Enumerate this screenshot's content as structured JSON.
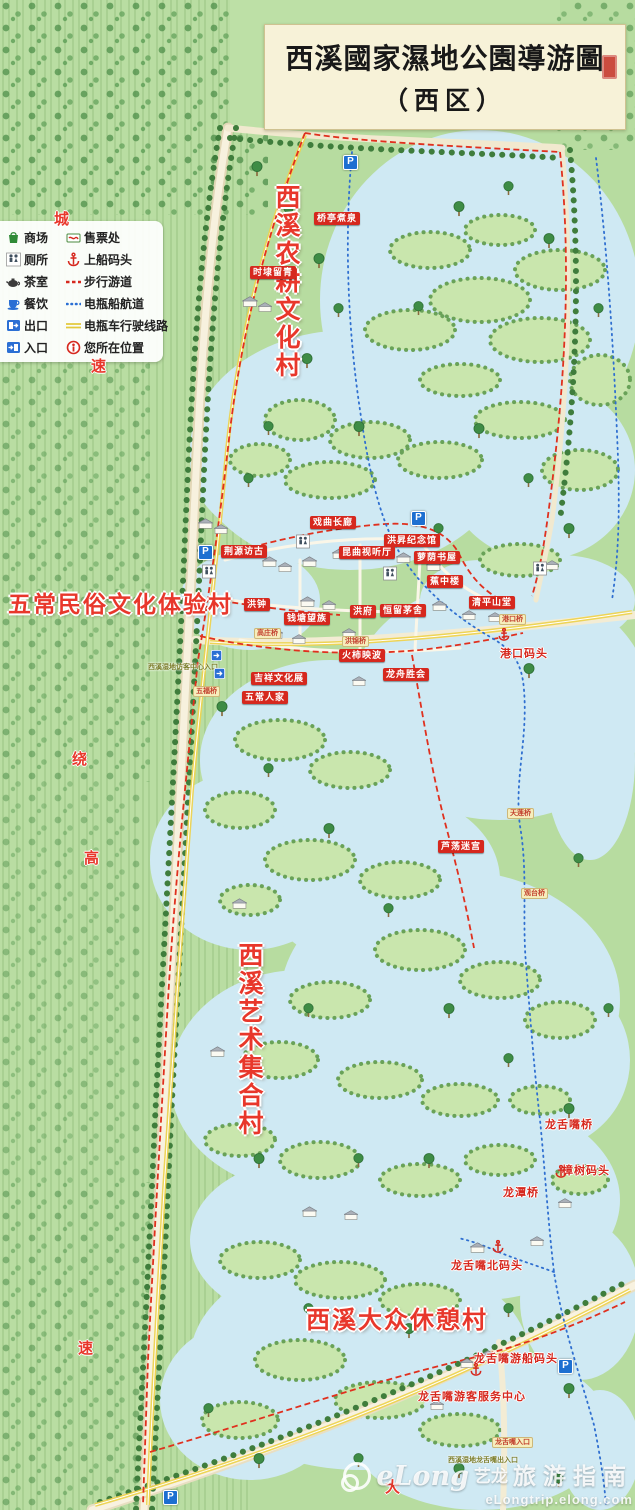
{
  "title": {
    "main": "西溪國家濕地公園導游圖",
    "sub": "（西区）"
  },
  "legend": {
    "items": [
      {
        "icon": "shop-icon",
        "label": "商场"
      },
      {
        "icon": "ticket-office-icon",
        "label": "售票处"
      },
      {
        "icon": "toilet-icon",
        "label": "厕所"
      },
      {
        "icon": "boat-dock-icon",
        "label": "上船码头"
      },
      {
        "icon": "tea-room-icon",
        "label": "茶室"
      },
      {
        "icon": "walking-route-icon",
        "label": "步行游道"
      },
      {
        "icon": "dining-icon",
        "label": "餐饮"
      },
      {
        "icon": "boat-route-icon",
        "label": "电瓶船航道"
      },
      {
        "icon": "exit-icon",
        "label": "出口"
      },
      {
        "icon": "cart-route-icon",
        "label": "电瓶车行驶线路"
      },
      {
        "icon": "entrance-icon",
        "label": "入口"
      },
      {
        "icon": "current-location-icon",
        "label": "您所在位置"
      }
    ]
  },
  "villages": [
    {
      "name": "西溪农耕文化村"
    },
    {
      "name": "五常民俗文化体验村"
    },
    {
      "name": "西溪艺术集合村"
    },
    {
      "name": "西溪大众休憩村"
    }
  ],
  "pois": [
    {
      "label": "桥亭煮泉",
      "x": 314,
      "y": 212
    },
    {
      "label": "时埭留青",
      "x": 250,
      "y": 266
    },
    {
      "label": "荆源访古",
      "x": 221,
      "y": 545
    },
    {
      "label": "戏曲长廊",
      "x": 310,
      "y": 516
    },
    {
      "label": "洪昇纪念馆",
      "x": 384,
      "y": 534
    },
    {
      "label": "昆曲视听厅",
      "x": 339,
      "y": 546
    },
    {
      "label": "萝荫书屋",
      "x": 414,
      "y": 551
    },
    {
      "label": "洪钟",
      "x": 244,
      "y": 598
    },
    {
      "label": "蕉中楼",
      "x": 427,
      "y": 575
    },
    {
      "label": "清平山堂",
      "x": 469,
      "y": 596
    },
    {
      "label": "钱塘望族",
      "x": 284,
      "y": 612
    },
    {
      "label": "洪府",
      "x": 350,
      "y": 605
    },
    {
      "label": "恒留茅舍",
      "x": 380,
      "y": 604
    },
    {
      "label": "火柿映波",
      "x": 339,
      "y": 649
    },
    {
      "label": "吉祥文化展",
      "x": 251,
      "y": 672
    },
    {
      "label": "五常人家",
      "x": 242,
      "y": 691
    },
    {
      "label": "龙舟胜会",
      "x": 383,
      "y": 668
    },
    {
      "label": "芦荡迷宫",
      "x": 438,
      "y": 840
    }
  ],
  "red_texts": [
    {
      "label": "港口码头",
      "x": 500,
      "y": 645
    },
    {
      "label": "龙舌嘴桥",
      "x": 545,
      "y": 1116
    },
    {
      "label": "樟树码头",
      "x": 562,
      "y": 1162
    },
    {
      "label": "龙潭桥",
      "x": 503,
      "y": 1184
    },
    {
      "label": "龙舌嘴北码头",
      "x": 451,
      "y": 1257
    },
    {
      "label": "龙舌嘴游船码头",
      "x": 474,
      "y": 1350
    },
    {
      "label": "龙舌嘴游客服务中心",
      "x": 418,
      "y": 1388
    }
  ],
  "bridges": [
    {
      "label": "港口桥",
      "x": 499,
      "y": 614
    },
    {
      "label": "高庄桥",
      "x": 254,
      "y": 628
    },
    {
      "label": "洪锦桥",
      "x": 342,
      "y": 636
    },
    {
      "label": "五福桥",
      "x": 193,
      "y": 686
    },
    {
      "label": "天莲桥",
      "x": 507,
      "y": 808
    },
    {
      "label": "观台桥",
      "x": 521,
      "y": 888
    },
    {
      "label": "龙舌嘴入口",
      "x": 492,
      "y": 1437
    }
  ],
  "olive_labels": [
    {
      "label": "西溪湿地访客中心入口",
      "x": 148,
      "y": 662
    },
    {
      "label": "西溪湿地龙舌嘴出入口",
      "x": 448,
      "y": 1455
    }
  ],
  "road_chars": [
    {
      "ch": "城",
      "x": 54,
      "y": 208
    },
    {
      "ch": "速",
      "x": 91,
      "y": 355
    },
    {
      "ch": "绕",
      "x": 72,
      "y": 748
    },
    {
      "ch": "高",
      "x": 84,
      "y": 847
    },
    {
      "ch": "速",
      "x": 78,
      "y": 1337
    },
    {
      "ch": "大",
      "x": 385,
      "y": 1476
    }
  ],
  "parking_icons": [
    {
      "glyph": "P",
      "x": 343,
      "y": 155
    },
    {
      "glyph": "P",
      "x": 411,
      "y": 511
    },
    {
      "glyph": "P",
      "x": 198,
      "y": 545
    },
    {
      "glyph": "P",
      "x": 558,
      "y": 1359
    },
    {
      "glyph": "P",
      "x": 163,
      "y": 1490
    }
  ],
  "anchor_icons": [
    {
      "x": 497,
      "y": 627
    },
    {
      "x": 554,
      "y": 1164
    },
    {
      "x": 491,
      "y": 1239
    },
    {
      "x": 469,
      "y": 1362
    }
  ],
  "toilet_icons": [
    {
      "x": 296,
      "y": 534
    },
    {
      "x": 383,
      "y": 566
    },
    {
      "x": 533,
      "y": 561
    },
    {
      "x": 202,
      "y": 564
    }
  ],
  "exit_icons": [
    {
      "x": 211,
      "y": 648
    },
    {
      "x": 214,
      "y": 666
    }
  ],
  "watermark": {
    "brand": "eLong",
    "brand_cn": "艺龙",
    "guide": "旅游指南",
    "url": "eLongtrip.elong.com"
  }
}
